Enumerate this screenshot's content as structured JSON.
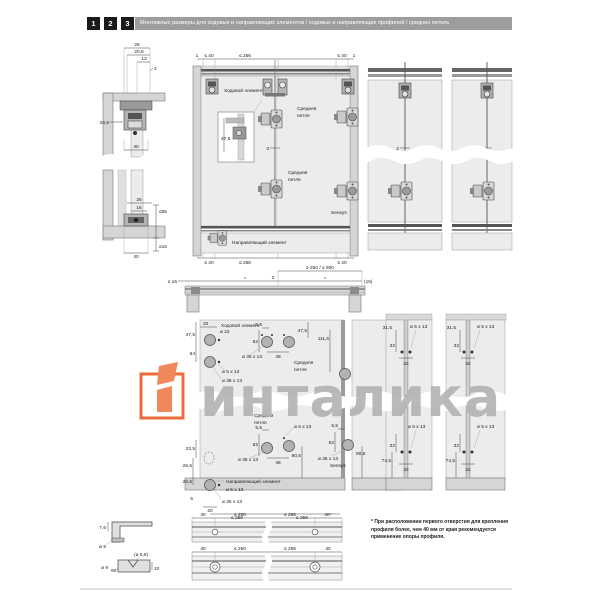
{
  "header": {
    "steps": [
      "1",
      "2",
      "3"
    ],
    "title": "Монтажные размеры для ходовых и направляющих элементов / ходовых и направляющих профилей / средних петель"
  },
  "topLeft": {
    "upper": {
      "d26": "26",
      "d205": "20,5",
      "d13": "13",
      "d2": "2",
      "d265": "26,5",
      "d40": "40"
    },
    "lower": {
      "d26": "26",
      "d16": "16",
      "d55": "≤55",
      "d15": "≥15",
      "d40": "40"
    }
  },
  "frontView": {
    "top": {
      "one_l": "1",
      "le40_l": "≤ 40",
      "le256": "≤ 256",
      "le40_r": "≤ 40",
      "one_r": "1"
    },
    "labels": {
      "running": "Ходовой элемент",
      "hinge1a": "Средняя",
      "hinge1b": "петля",
      "inset": "47,5",
      "gap": "3",
      "hinge2a": "Средняя",
      "hinge2b": "петля",
      "sensys": "Sensys",
      "guide": "Направляющий элемент"
    },
    "bottom": {
      "le40_l": "≤ 40",
      "le256": "≤ 256",
      "le40_r": "≤ 40"
    }
  },
  "rightViews": {
    "gap_a": "2",
    "gap_b": "2"
  },
  "plan": {
    "span": "≥ 250 / ≤ 600",
    "le15": "≤ 15",
    "eq1": "=",
    "d2": "2",
    "eq2": "=",
    "p15": "(15)"
  },
  "drill": {
    "running": "Ходовой элемент",
    "d20_top": "20",
    "d47_5": "47,5",
    "dia22": "ø 22",
    "d64": "64",
    "dia5_run": "ø 5 x 13",
    "dia35_run": "ø 35 x 13",
    "h1_55": "5,5",
    "h1_52": "52",
    "h1_dia35": "ø 35 x 13",
    "h1_48": "48",
    "h1_a": "Средняя",
    "h1_b": "петля",
    "d111_5": "111,5",
    "d47_5r": "47,5",
    "h2_a": "Средняя",
    "h2_b": "петля",
    "h2_55": "5,5",
    "h2_52": "52",
    "h2_dia35": "ø 35 x 13",
    "h2_48": "48",
    "h2_905": "90,5",
    "h2_dia5": "ø 5 x 13",
    "g22_5": "22,5",
    "g26_5a": "26,5",
    "g26_5b": "26,5",
    "guide": "Направляющий элемент",
    "g_dia5": "ø 5 x 13",
    "g5": "5",
    "g_dia35": "ø 35 x 13",
    "g20": "20",
    "g256a": "≤ 256",
    "g256b": "≤ 256",
    "s_55": "5,5",
    "s_52": "52",
    "s_905": "90,5",
    "s_dia35": "ø 35 x 13",
    "sensys": "Sensys"
  },
  "strips": {
    "t1_315": "31,5",
    "t1_32a": "32",
    "t1_dia5": "ø 5 x 13",
    "t1_32b": "32",
    "t2_315": "31,5",
    "t2_32a": "32",
    "t2_dia5": "ø 5 x 13",
    "t2_32b": "32",
    "b1_32a": "32",
    "b1_745": "74,5",
    "b1_32b": "32",
    "b1_dia5": "ø 5 x 13",
    "b2_32a": "32",
    "b2_745": "74,5",
    "b2_32b": "32",
    "b2_dia5": "ø 5 x 13"
  },
  "profiles": {
    "r1_76": "7,6",
    "r1_dia5": "ø 5",
    "r1_40l": "40",
    "r1_250": "≤ 250",
    "r1_256": "≤ 256",
    "r1_40r": "40*",
    "r2_dia58": "(ø 5,8)",
    "r2_dia9": "ø 9",
    "r2_90": "90°",
    "r2_10": "10",
    "r2_40l": "40",
    "r2_250": "≤ 250",
    "r2_256": "≤ 256",
    "r2_40r": "40"
  },
  "footnote": "* При расположении первого отверстия для крепления профиля более, чем 40 мм от края рекомендуется применение опоры профиля.",
  "watermark": {
    "text": "инталика"
  },
  "colors": {
    "accent": "#e8612c",
    "watermark_gray": "#b4b4b4",
    "header_bar": "#9d9d9d",
    "step_bg": "#1a1a1a"
  }
}
